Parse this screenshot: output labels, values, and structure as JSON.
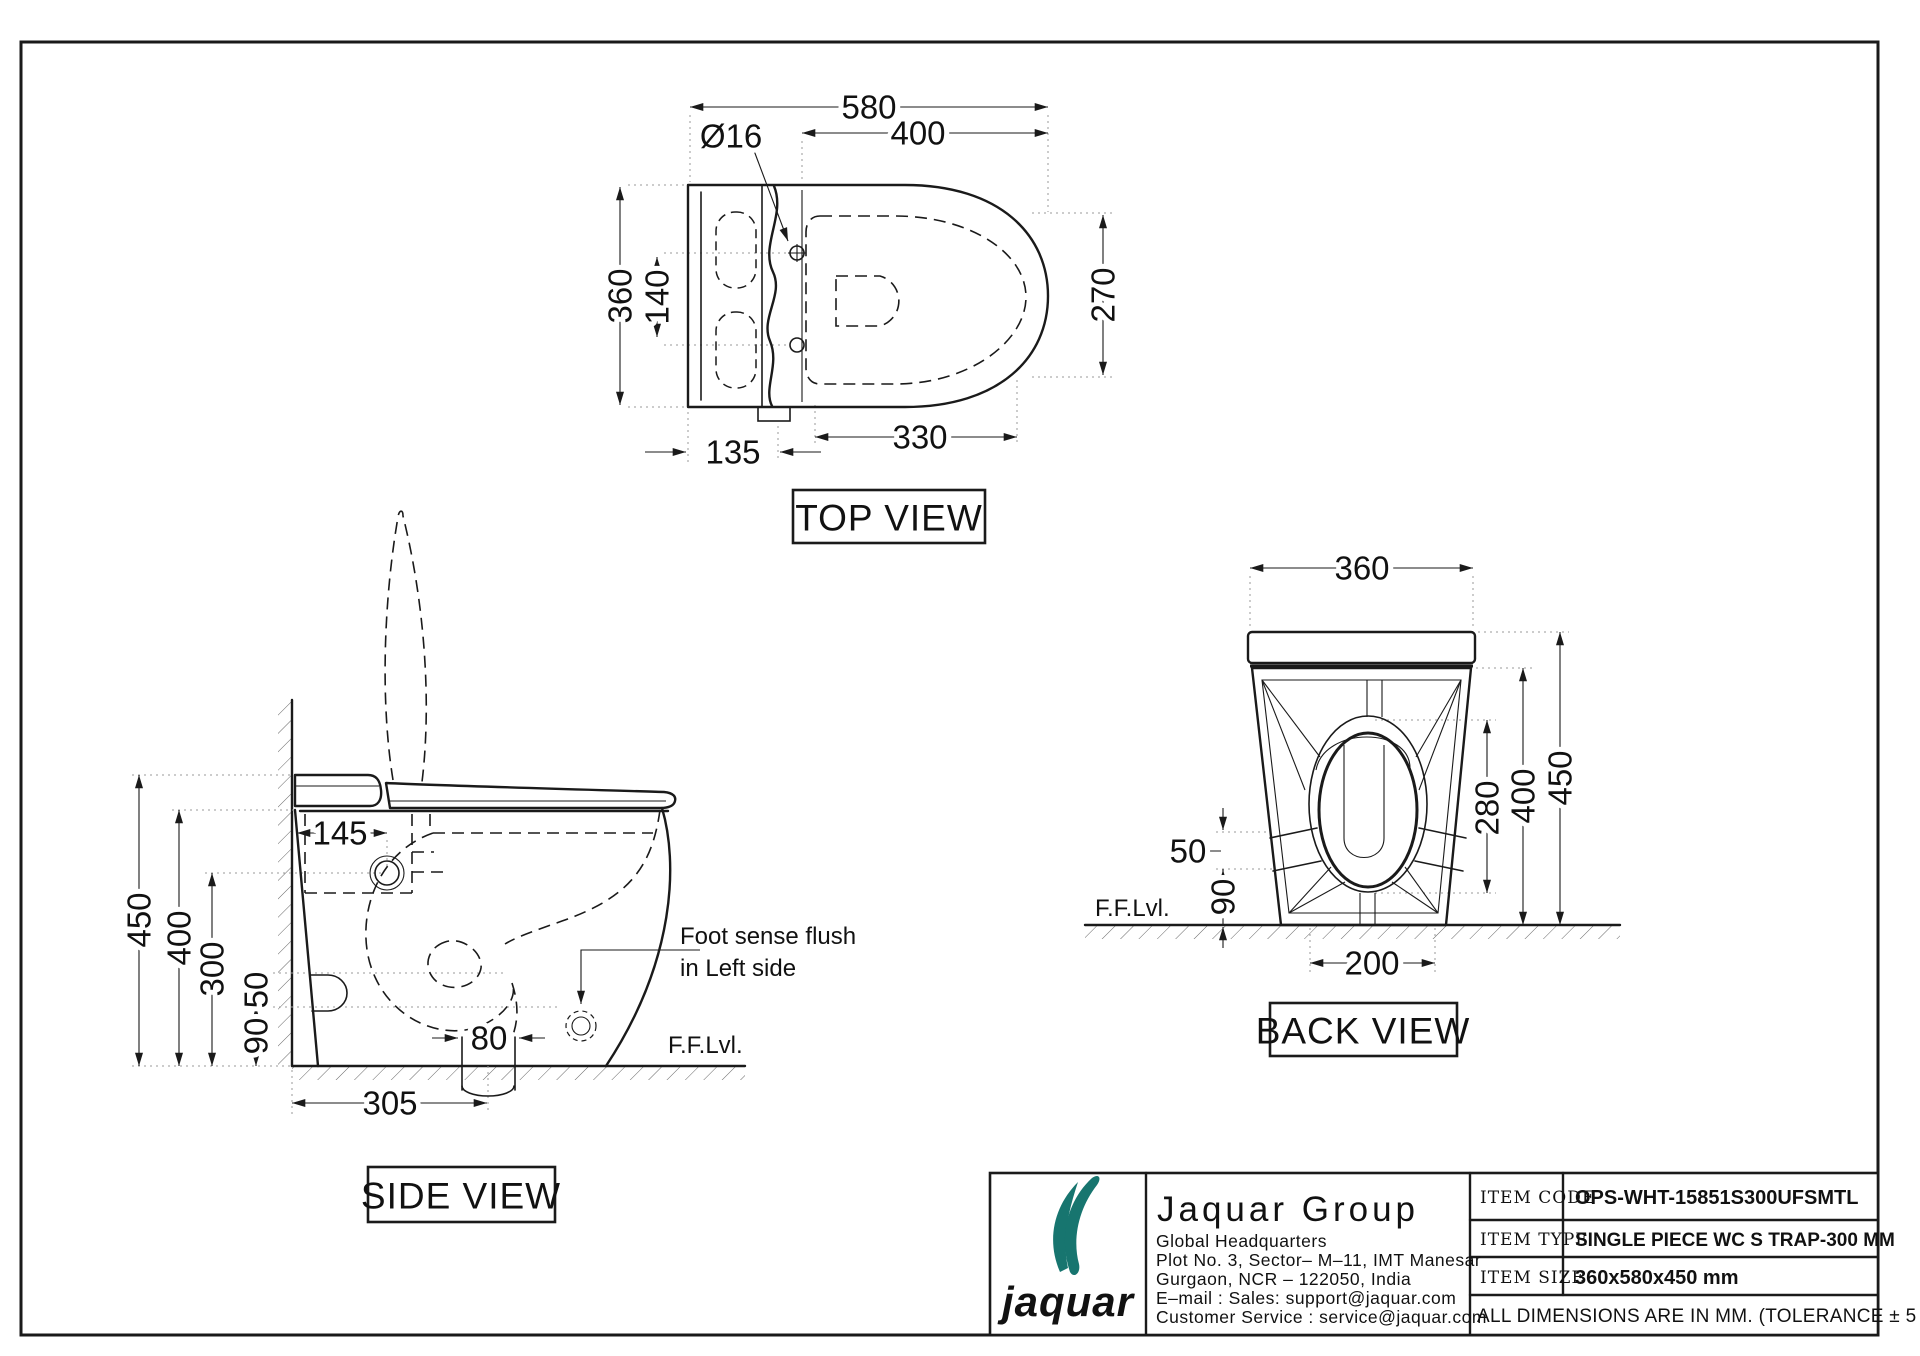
{
  "page": {
    "bg": "#ffffff",
    "line_color": "#1a1a1a",
    "accent_teal": "#17756f",
    "tolerance_note": "ALL DIMENSIONS ARE IN MM. (TOLERANCE ± 5 MM)"
  },
  "views": {
    "top": {
      "label": "TOP VIEW",
      "overall_length": "580",
      "seat_length": "400",
      "hole_dia": "Ø16",
      "width": "360",
      "holes_cc": "140",
      "bowl_width": "270",
      "bowl_length": "330",
      "tank_depth": "135"
    },
    "side": {
      "label": "SIDE VIEW",
      "total_height": "450",
      "seat_height": "400",
      "inlet_height": "300",
      "band_height": "50",
      "base_height": "90",
      "tank_inner": "145",
      "outlet_width": "80",
      "trap_distance": "305",
      "floor_label": "F.F.Lvl.",
      "note_line1": "Foot sense flush",
      "note_line2": "in Left side"
    },
    "back": {
      "label": "BACK VIEW",
      "width": "360",
      "bowl_height": "280",
      "body_height": "400",
      "total_height": "450",
      "band_height": "50",
      "base_height": "90",
      "foot_width": "200",
      "floor_label": "F.F.Lvl."
    }
  },
  "title_block": {
    "logo_text": "jaquar",
    "company": "Jaquar Group",
    "address_lines": [
      "Global Headquarters",
      "Plot No. 3, Sector– M–11, IMT Manesar",
      "Gurgaon, NCR – 122050, India",
      "E–mail : Sales: support@jaquar.com",
      "Customer Service : service@jaquar.com"
    ],
    "rows": [
      {
        "label": "ITEM CODE",
        "value": "OPS-WHT-15851S300UFSMTL"
      },
      {
        "label": "ITEM TYPE",
        "value": "SINGLE PIECE WC S TRAP-300 MM"
      },
      {
        "label": "ITEM SIZE",
        "value": "360x580x450 mm"
      }
    ],
    "note": "ALL DIMENSIONS ARE IN MM. (TOLERANCE ± 5 MM)"
  }
}
